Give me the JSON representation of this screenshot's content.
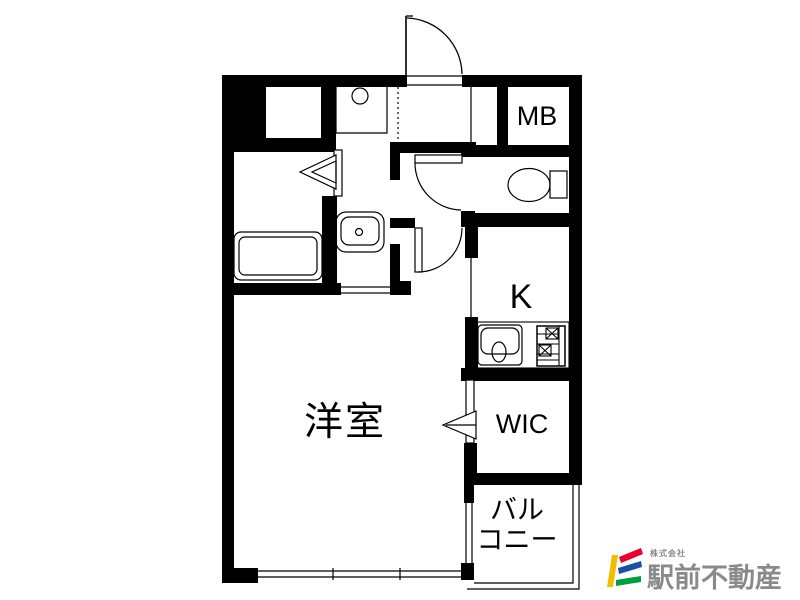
{
  "plan": {
    "rooms": {
      "western_room": "洋室",
      "kitchen": "K",
      "wic": "WIC",
      "meter_box": "MB",
      "balcony_line1": "バル",
      "balcony_line2": "コニー"
    }
  },
  "logo": {
    "company_prefix": "株式会社",
    "company_name": "駅前不動産",
    "colors": {
      "yellow": "#EFBF00",
      "red": "#E8002D",
      "blue": "#1D50A5",
      "green": "#009F3C",
      "text_gray": "#8A8A8A"
    }
  },
  "canvas": {
    "background": "#FFFFFF",
    "line_color": "#000000"
  }
}
